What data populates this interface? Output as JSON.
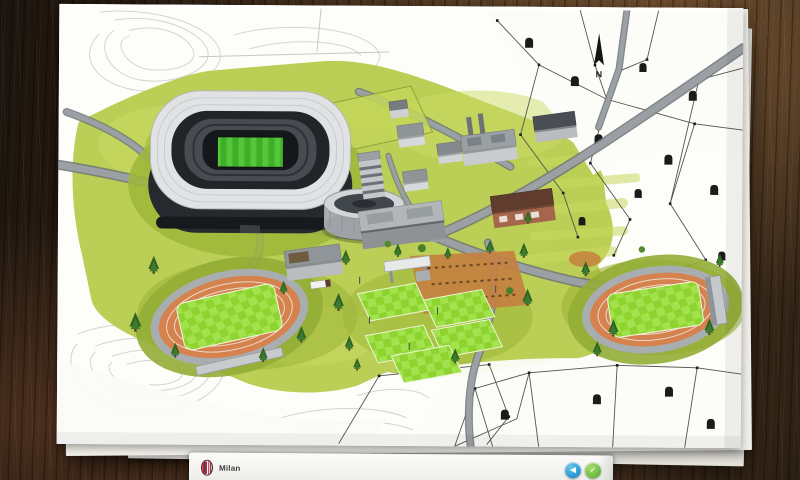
{
  "scene": {
    "environment": "facility-blueprint-on-wooden-desk",
    "map_features": [
      "stadium",
      "indoor-arena",
      "training-pitches",
      "athletics-track-west",
      "athletics-track-east",
      "office-buildings",
      "factory",
      "warehouse",
      "fuel-station",
      "residential-parcels",
      "roads",
      "trees",
      "contour-sketch",
      "north-arrow"
    ]
  },
  "map": {
    "compass_label": "N"
  },
  "bottom_bar": {
    "team_name": "Milan",
    "crest_icon": "club-crest-icon",
    "buttons": [
      {
        "name": "back-button",
        "icon": "back-arrow-icon",
        "glyph": "◀",
        "color": "#2d9ed6"
      },
      {
        "name": "confirm-button",
        "icon": "check-icon",
        "glyph": "✓",
        "color": "#72bf44"
      }
    ]
  },
  "palette": {
    "wood_dark": "#241a10",
    "wood_light": "#6a4a2c",
    "paper": "#fbfbf8",
    "grass_wash": "#b7cb4c",
    "pitch_green": "#8fd62e",
    "track_orange": "#d5824e",
    "road_gray": "#9aa0a4",
    "stands_dark": "#33373d",
    "parcel_ink": "#1f1f1d"
  }
}
